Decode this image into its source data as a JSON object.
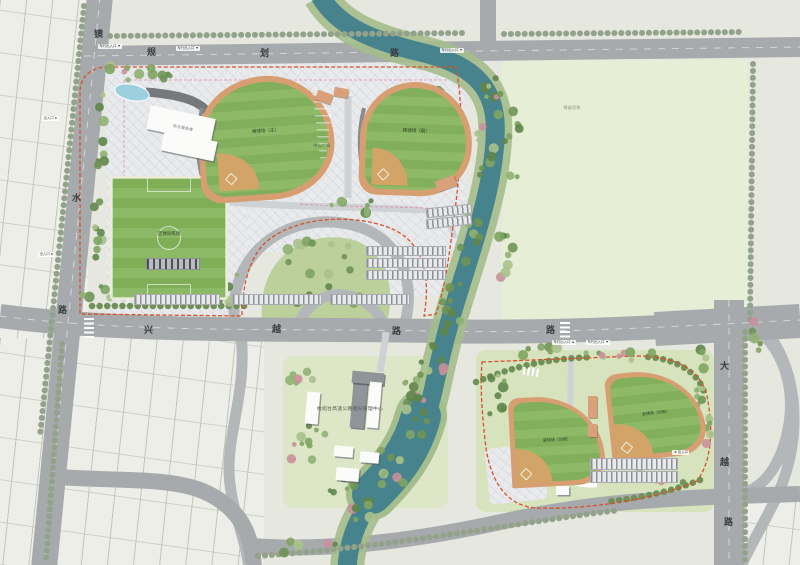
{
  "roads": {
    "left": {
      "name": "镜水路",
      "chars": [
        "镜",
        "水",
        "路"
      ]
    },
    "top": {
      "name": "规划路",
      "chars": [
        "规",
        "划",
        "路"
      ]
    },
    "middle": {
      "name": "兴越路",
      "chars": [
        "兴",
        "越",
        "路",
        "路"
      ]
    },
    "right": {
      "name": "大越路",
      "chars": [
        "大",
        "越",
        "路"
      ]
    }
  },
  "areas": {
    "reserved_label": "预留用地",
    "mgmt_center_label": "杭绍台高速公路绍兴管理中心",
    "plaza_label": "中心广场"
  },
  "fields": {
    "soccer_label": "足球训练场",
    "baseball_main_label": "棒球场（主）",
    "baseball_second_label": "棒球场（副）",
    "training_left_label": "垒球场（训练）",
    "training_right_label": "垒球场（训练）"
  },
  "buildings": {
    "service_label": "综合服务楼"
  },
  "markers": {
    "vehicle_entrance": "车行出入口",
    "entrance": "出入口"
  },
  "colors": {
    "road": "#a7aaac",
    "ramp": "#b4b7b9",
    "river": "#47838c",
    "bank": "#a4bd8c",
    "grass": "#86b160",
    "track": "#d79e72",
    "reserved": "#e6eed6",
    "boundary": "#d94f2b",
    "pink_line": "#e489b8"
  }
}
